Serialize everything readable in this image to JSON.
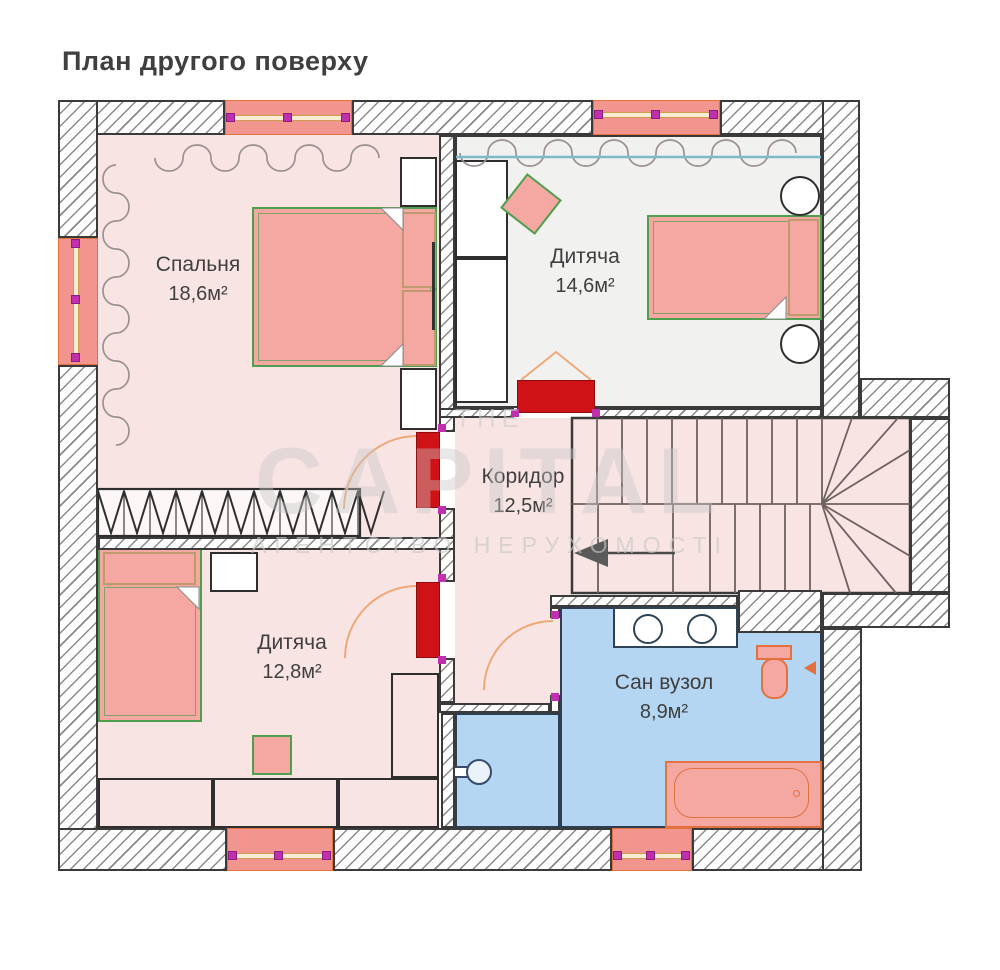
{
  "title": "План другого поверху",
  "rooms": [
    {
      "id": "bedroom",
      "name": "Спальня",
      "area": "18,6м²"
    },
    {
      "id": "kids-top",
      "name": "Дитяча",
      "area": "14,6м²"
    },
    {
      "id": "corridor",
      "name": "Коридор",
      "area": "12,5м²"
    },
    {
      "id": "kids-bottom",
      "name": "Дитяча",
      "area": "12,8м²"
    },
    {
      "id": "bathroom",
      "name": "Сан вузол",
      "area": "8,9м²"
    }
  ],
  "watermark": {
    "line1": "THE",
    "line2": "CAPITAL",
    "line3": "АГЕНТСТВО НЕРУХОМОСТІ"
  },
  "colors": {
    "floor_pink": "#f9e4e4",
    "floor_gray": "#f1f1ef",
    "floor_blue": "#b5d6f2",
    "hatch_line": "#8a8a8a",
    "ink": "#3a3a3a",
    "window_salmon": "#f2958e",
    "window_orange": "#e2713f",
    "cream": "#f8edd2",
    "magenta": "#bf2fae",
    "door_red": "#cf1215",
    "furn_salmon": "#f5a7a1",
    "furn_green": "#4ea04e",
    "furn_tan": "#bf9a6e",
    "arc_orange": "#efa878",
    "teal": "#7cb9ca",
    "navy": "#2c3e50",
    "label": "#3f3f3f"
  }
}
